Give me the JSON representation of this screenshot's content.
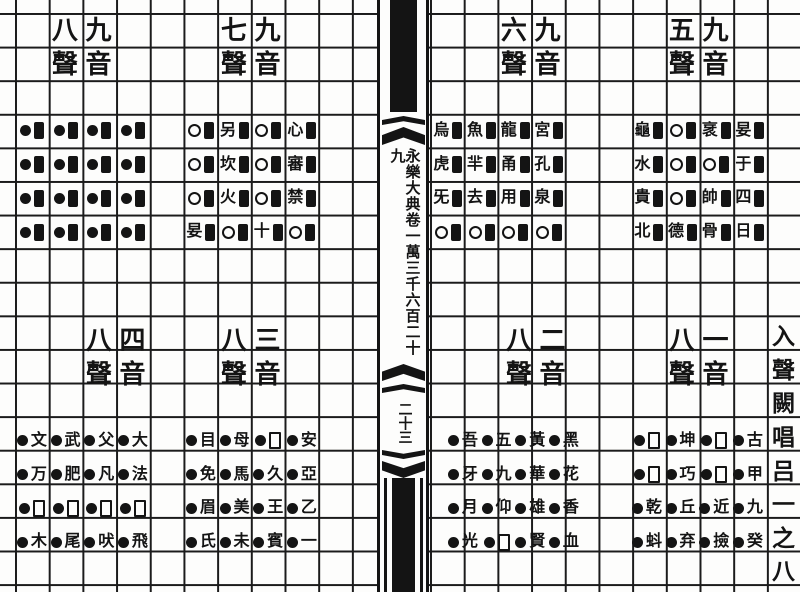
{
  "page": {
    "kind": "scanned encyclopedia page",
    "paper_color": "#fdfdfc",
    "ink_color": "#141414"
  },
  "spine": {
    "title": "永樂大典卷一萬三千六百二十九",
    "page_number": "二十三"
  },
  "right_margin": {
    "text": "入聲闕唱吕一之八"
  },
  "groups": [
    {
      "name": "upper-left",
      "header_left": "八聲",
      "header_right": "九音",
      "cells": [
        "●▮",
        "●▮",
        "●▮",
        "●▮",
        "●▮",
        "●▮",
        "●▮",
        "●▮",
        "●▮",
        "●▮",
        "●▮",
        "●▮",
        "●▮",
        "●▮",
        "●▮",
        "●▮"
      ]
    },
    {
      "name": "upper-mid-left",
      "header_left": "七聲",
      "header_right": "九音",
      "cells": [
        "○▮",
        "另▮",
        "○▮",
        "心▮",
        "○▮",
        "坎▮",
        "○▮",
        "審▮",
        "○▮",
        "火▮",
        "○▮",
        "禁▮",
        "妟▮",
        "○▮",
        "十▮",
        "○▮"
      ]
    },
    {
      "name": "upper-mid-right",
      "header_left": "六聲",
      "header_right": "九音",
      "cells": [
        "烏▮",
        "魚▮",
        "龍▮",
        "宮▮",
        "虎▮",
        "羋▮",
        "甬▮",
        "孔▮",
        "旡▮",
        "去▮",
        "用▮",
        "泉▮",
        "○▮",
        "○▮",
        "○▮",
        "○▮"
      ]
    },
    {
      "name": "upper-right",
      "header_left": "五聲",
      "header_right": "九音",
      "cells": [
        "龜▮",
        "○▮",
        "衺▮",
        "妟▮",
        "水▮",
        "○▮",
        "○▮",
        "于▮",
        "貴▮",
        "○▮",
        "帥▮",
        "四▮",
        "北▮",
        "德▮",
        "骨▮",
        "日▮"
      ]
    },
    {
      "name": "lower-left",
      "header_left": "八聲",
      "header_right": "四音",
      "cells": [
        "●文",
        "●武",
        "●父",
        "●大",
        "●万",
        "●肥",
        "●凡",
        "●法",
        "●□",
        "●□",
        "●□",
        "●□",
        "●木",
        "●尾",
        "●吠",
        "●飛"
      ]
    },
    {
      "name": "lower-mid-left",
      "header_left": "八聲",
      "header_right": "三音",
      "cells": [
        "●目",
        "●母",
        "●□",
        "●安",
        "●免",
        "●馬",
        "●久",
        "●亞",
        "●眉",
        "●美",
        "●王",
        "●乙",
        "●氏",
        "●未",
        "●賓",
        "●一"
      ]
    },
    {
      "name": "lower-mid-right",
      "header_left": "八聲",
      "header_right": "二音",
      "cells": [
        "●吾",
        "●五",
        "●黃",
        "●黑",
        "●牙",
        "●九",
        "●華",
        "●花",
        "●月",
        "●仰",
        "●雄",
        "●香",
        "●光",
        "●□",
        "●賢",
        "●血"
      ]
    },
    {
      "name": "lower-right",
      "header_left": "八聲",
      "header_right": "一音",
      "cells": [
        "●□",
        "●坤",
        "●□",
        "●古",
        "●□",
        "●巧",
        "●□",
        "●甲",
        "●乾",
        "●丘",
        "●近",
        "●九",
        "●蚪",
        "●弃",
        "●撿",
        "●癸"
      ]
    }
  ]
}
